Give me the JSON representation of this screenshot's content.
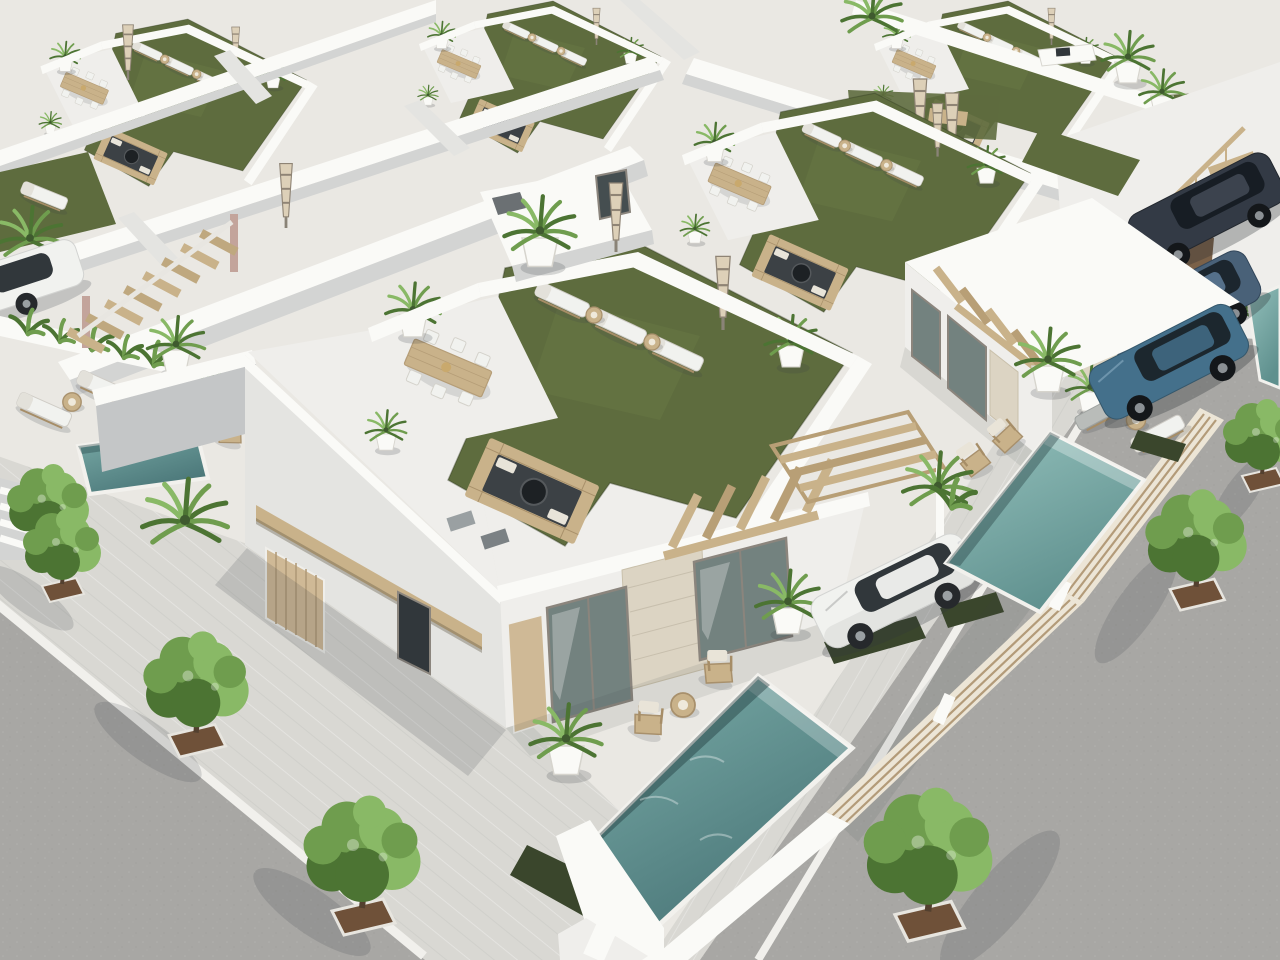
{
  "meta": {
    "type": "3d-architectural-render",
    "view": "aerial three-quarter view",
    "description": "Aerial 3D architectural rendering of a new development of modern flat-roofed white villas. Each villa has a rooftop terrace with artificial grass, sun loungers, closed patio umbrellas, a wooden dining table with white chairs, a sunken lounge with fire pit and potted palms. The foreground corner villa has a glass-and-stone facade, a private pool, wooden deck chairs and a white sedan parked in the driveway behind a wooden slat fence. A neighbouring villa has a blue SUV, a second pool and loungers. Two dark SUVs are parked along the right street. Asphalt streets with paved sidewalks and young green trees in square planters border the block on the lower-left and right."
  },
  "palette": {
    "ground": "#eae8e3",
    "pavement": "#d9d8d3",
    "asphalt": "#a8a7a4",
    "curb": "#f1f0ec",
    "wallSun": "#fafaf7",
    "wallLight": "#efeeeb",
    "wallMid": "#e4e4e1",
    "wallShade": "#d3d4d3",
    "wallDark": "#c4c6c7",
    "grassRoof": "#5e6c3e",
    "grassLight": "#6e7d49",
    "grassDark": "#3a462c",
    "poolA1": "#7bada9",
    "poolA2": "#4a7678",
    "poolB1": "#93c0bb",
    "poolB2": "#5f908e",
    "wood": "#c9b28a",
    "woodDark": "#a68d67",
    "doorBeige": "#cfb996",
    "stone": "#dcd4c3",
    "glass": "#73827f",
    "glassDark": "#454e50",
    "windowDark": "#31373b",
    "treeGreen": "#6f9d4e",
    "treeLight": "#89b966",
    "treeDark": "#4c7433",
    "trunk": "#53402f",
    "dirt": "#6f5139",
    "carWhite": "#f1f2ef",
    "carBlue": "#44708b",
    "carNavy": "#333a45",
    "carSteel": "#496178",
    "metal": "#9aa0a3",
    "shadow": "rgba(60,66,72,0.17)",
    "shadowSoft": "rgba(60,66,72,0.10)"
  },
  "scene": {
    "villas": "repeating rows of white flat-roofed villas with parapet walls",
    "roof_terrace_items": [
      "artificial grass lawn",
      "sun loungers",
      "round rattan side tables",
      "wooden dining table with six white chairs",
      "sunken lounge with fire bowl",
      "closed checkered patio umbrellas",
      "potted palms in white planters",
      "roof stair bulkhead with window"
    ],
    "pools": [
      {
        "location": "front corner villa, lower centre",
        "water": "deep teal"
      },
      {
        "location": "right villa, along slat fence",
        "water": "light teal"
      },
      {
        "location": "left patio, small plunge pool",
        "water": "teal"
      },
      {
        "location": "far right edge, partial",
        "water": "light teal"
      }
    ],
    "vehicles": [
      {
        "type": "white sedan",
        "location": "centre driveway under pergola"
      },
      {
        "type": "blue SUV",
        "location": "right villa carport"
      },
      {
        "type": "steel-blue SUV",
        "location": "top-right street"
      },
      {
        "type": "navy SUV",
        "location": "top-right street"
      },
      {
        "type": "white car (partial)",
        "location": "left image edge"
      }
    ],
    "streets": [
      {
        "position": "bottom-left",
        "surface": "asphalt",
        "sidewalk": "paved with 3 trees in square planters"
      },
      {
        "position": "right",
        "surface": "asphalt",
        "sidewalk": "paved with 3 trees in square planters"
      }
    ],
    "stairs": [
      "concrete stair with wooden handrail, top-right",
      "wooden open stair, mid-left",
      "white steps, lower-left"
    ],
    "pergolas": [
      "wood slat pergola over driveway carport",
      "wood beams over facade walkway",
      "wood beams over left stair"
    ],
    "fences": [
      "horizontal wood slat fence along right property line",
      "beige slat garage doors on street facade"
    ]
  }
}
